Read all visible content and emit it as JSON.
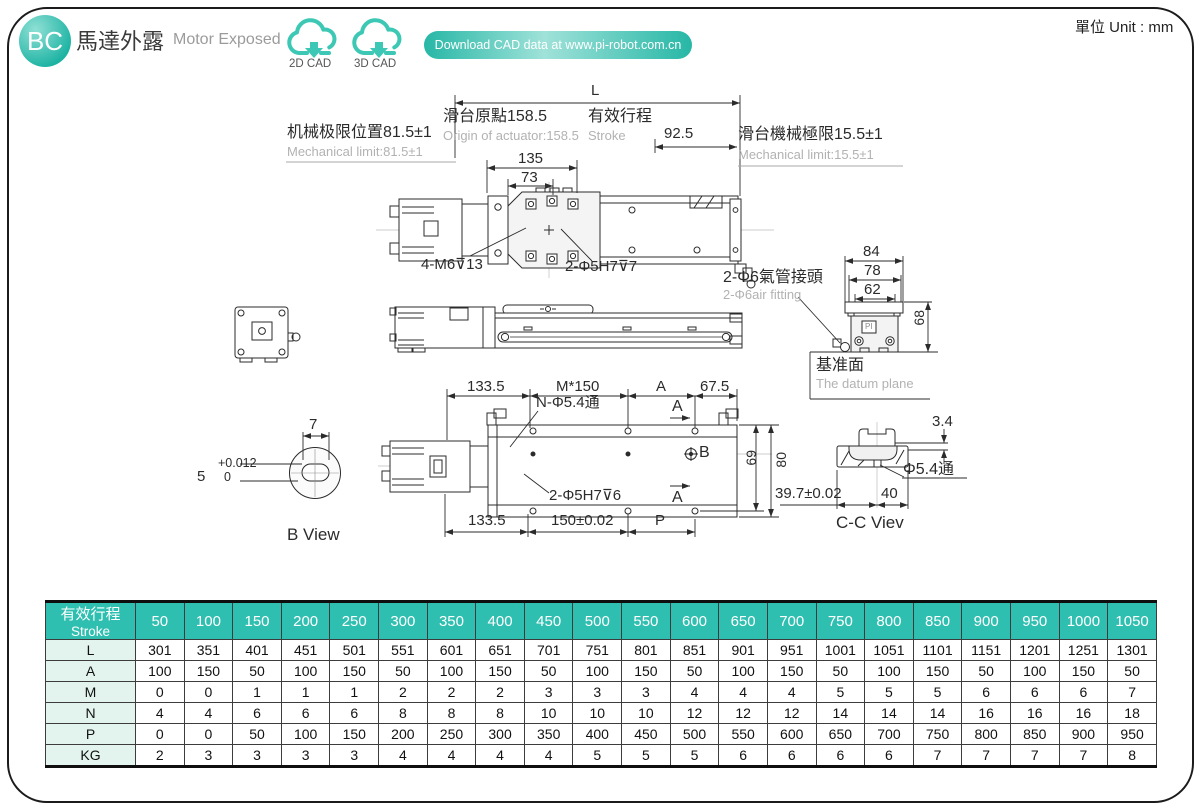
{
  "unit": "單位 Unit : mm",
  "header": {
    "badge": "BC",
    "title_zh": "馬達外露",
    "title_en": "Motor Exposed",
    "cad2d": "2D CAD",
    "cad3d": "3D CAD",
    "banner": "Download CAD data at www.pi-robot.com.cn"
  },
  "drawing": {
    "top": {
      "L": "L",
      "origin_zh": "滑台原點158.5",
      "origin_en": "Origin of actuator:158.5",
      "stroke_zh": "有效行程",
      "stroke_en": "Stroke",
      "d925": "92.5",
      "limit_left_zh": "机械极限位置81.5±1",
      "limit_left_en": "Mechanical limit:81.5±1",
      "limit_right_zh": "滑台機械極限15.5±1",
      "limit_right_en": "Mechanical limit:15.5±1",
      "d135": "135",
      "d73": "73",
      "m6": "4-M6⊽13",
      "h7": "2-Φ5H7⊽7"
    },
    "fitting": {
      "air_zh": "2-Φ6氣管接頭",
      "air_en": "2-Φ6air fitting",
      "d84": "84",
      "d78": "78",
      "d62": "62",
      "d68": "68",
      "datum_zh": "基准面",
      "datum_en": "The datum plane",
      "logo": "PI"
    },
    "plan": {
      "d1335a": "133.5",
      "m150": "M*150",
      "dA": "A",
      "d675": "67.5",
      "n54": "N-Φ5.4通",
      "secA1": "A",
      "secA2": "A",
      "B": "B",
      "d69": "69",
      "d80": "80",
      "h7": "2-Φ5H7⊽6",
      "d1335b": "133.5",
      "d150": "150±0.02",
      "dP": "P"
    },
    "bview": {
      "d7": "7",
      "tol_top": "+0.012",
      "tol_val": "5",
      "tol_bottom": "0",
      "label": "B View"
    },
    "ccview": {
      "d34": "3.4",
      "d54": "Φ5.4通",
      "d397": "39.7±0.02",
      "d40": "40",
      "label": "C-C Viev"
    }
  },
  "table": {
    "corner_zh": "有效行程",
    "corner_en": "Stroke",
    "columns": [
      "50",
      "100",
      "150",
      "200",
      "250",
      "300",
      "350",
      "400",
      "450",
      "500",
      "550",
      "600",
      "650",
      "700",
      "750",
      "800",
      "850",
      "900",
      "950",
      "1000",
      "1050"
    ],
    "rows": [
      {
        "label": "L",
        "values": [
          "301",
          "351",
          "401",
          "451",
          "501",
          "551",
          "601",
          "651",
          "701",
          "751",
          "801",
          "851",
          "901",
          "951",
          "1001",
          "1051",
          "1101",
          "1151",
          "1201",
          "1251",
          "1301"
        ]
      },
      {
        "label": "A",
        "values": [
          "100",
          "150",
          "50",
          "100",
          "150",
          "50",
          "100",
          "150",
          "50",
          "100",
          "150",
          "50",
          "100",
          "150",
          "50",
          "100",
          "150",
          "50",
          "100",
          "150",
          "50"
        ]
      },
      {
        "label": "M",
        "values": [
          "0",
          "0",
          "1",
          "1",
          "1",
          "2",
          "2",
          "2",
          "3",
          "3",
          "3",
          "4",
          "4",
          "4",
          "5",
          "5",
          "5",
          "6",
          "6",
          "6",
          "7"
        ]
      },
      {
        "label": "N",
        "values": [
          "4",
          "4",
          "6",
          "6",
          "6",
          "8",
          "8",
          "8",
          "10",
          "10",
          "10",
          "12",
          "12",
          "12",
          "14",
          "14",
          "14",
          "16",
          "16",
          "16",
          "18"
        ]
      },
      {
        "label": "P",
        "values": [
          "0",
          "0",
          "50",
          "100",
          "150",
          "200",
          "250",
          "300",
          "350",
          "400",
          "450",
          "500",
          "550",
          "600",
          "650",
          "700",
          "750",
          "800",
          "850",
          "900",
          "950"
        ]
      },
      {
        "label": "KG",
        "values": [
          "2",
          "3",
          "3",
          "3",
          "3",
          "4",
          "4",
          "4",
          "4",
          "5",
          "5",
          "5",
          "6",
          "6",
          "6",
          "6",
          "7",
          "7",
          "7",
          "7",
          "8"
        ]
      }
    ]
  },
  "colors": {
    "teal": "#2fbfb0",
    "teal_light": "#8fe0d5",
    "mint": "#e3f4ef",
    "grey_text": "#b2b2b2"
  }
}
